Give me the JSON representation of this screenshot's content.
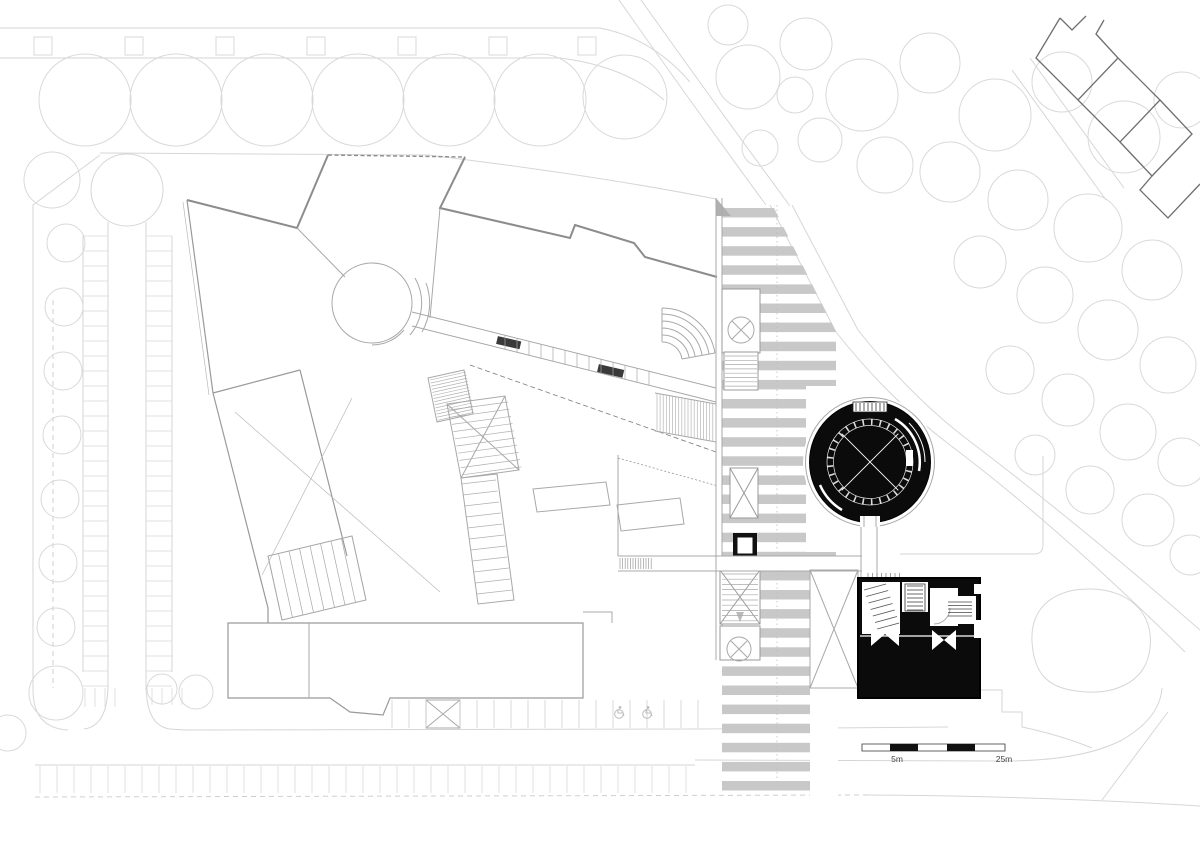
{
  "title": "Architectural site plan - ground floor",
  "scale_bar": {
    "label_left": "5m",
    "label_right": "25m"
  },
  "palette": {
    "background": "#ffffff",
    "line_faint": "#d6d6d6",
    "line_light": "#c8c8c8",
    "line_mid": "#a8a8a8",
    "line_dark": "#8c8c8c",
    "neighbor_outline": "#6e6e6e",
    "crosswalk_stripe": "#c8c8c8",
    "solid_black": "#0b0b0b",
    "label_text": "#444444",
    "wheelchair_icon": "#bdbdbd"
  },
  "icons": {
    "wheelchair": "wheelchair-icon",
    "column_cross": "circle-x-icon",
    "crossing_marker": "triangle-marker-icon"
  },
  "geometry": {
    "trees_top": [
      [
        85,
        100,
        46
      ],
      [
        176,
        100,
        46
      ],
      [
        267,
        100,
        46
      ],
      [
        358,
        100,
        46
      ],
      [
        449,
        100,
        46
      ],
      [
        540,
        100,
        46
      ],
      [
        625,
        97,
        42
      ]
    ],
    "trees_left": [
      [
        52,
        180,
        28
      ],
      [
        66,
        243,
        19
      ],
      [
        64,
        307,
        19
      ],
      [
        63,
        371,
        19
      ],
      [
        62,
        435,
        19
      ],
      [
        60,
        499,
        19
      ],
      [
        58,
        563,
        19
      ],
      [
        56,
        627,
        19
      ]
    ],
    "trees_right": [
      [
        728,
        25,
        20
      ],
      [
        748,
        77,
        32
      ],
      [
        806,
        44,
        26
      ],
      [
        862,
        95,
        36
      ],
      [
        930,
        63,
        30
      ],
      [
        995,
        115,
        36
      ],
      [
        1062,
        82,
        30
      ],
      [
        1124,
        137,
        36
      ],
      [
        1182,
        100,
        28
      ],
      [
        820,
        140,
        22
      ],
      [
        885,
        165,
        28
      ],
      [
        950,
        172,
        30
      ],
      [
        1018,
        200,
        30
      ],
      [
        1088,
        228,
        34
      ],
      [
        1152,
        270,
        30
      ],
      [
        980,
        262,
        26
      ],
      [
        1045,
        295,
        28
      ],
      [
        1108,
        330,
        30
      ],
      [
        1168,
        365,
        28
      ],
      [
        1010,
        370,
        24
      ],
      [
        1068,
        400,
        26
      ],
      [
        1128,
        432,
        28
      ],
      [
        1182,
        462,
        24
      ],
      [
        1035,
        455,
        20
      ],
      [
        1090,
        490,
        24
      ],
      [
        1148,
        520,
        26
      ],
      [
        1190,
        555,
        20
      ],
      [
        760,
        148,
        18
      ],
      [
        795,
        95,
        18
      ]
    ],
    "trees_bottom": [
      [
        56,
        693,
        27
      ],
      [
        8,
        733,
        18
      ],
      [
        162,
        689,
        15
      ],
      [
        196,
        692,
        17
      ]
    ],
    "squares_top": {
      "y": 37,
      "size": 18,
      "xs": [
        34,
        125,
        216,
        307,
        398,
        489,
        578
      ]
    },
    "crosswalk_stripes": {
      "x": 722,
      "width": 114,
      "y_start": 208,
      "period": 19.1,
      "height": 9.5,
      "count": 31
    },
    "hatches": [
      {
        "name": "left-stalls-west",
        "x1": 83,
        "y1": 236,
        "x2": 108,
        "y2": 236,
        "n": 31,
        "dx": 0,
        "dy": 15,
        "color": "#d9d9d9",
        "w": 0.8
      },
      {
        "name": "left-stalls-east",
        "x1": 146,
        "y1": 236,
        "x2": 172,
        "y2": 236,
        "n": 31,
        "dx": 0,
        "dy": 15,
        "color": "#d9d9d9",
        "w": 0.8
      },
      {
        "name": "bottom-stalls",
        "x1": 40,
        "y1": 766,
        "x2": 40,
        "y2": 793,
        "n": 39,
        "dx": 17,
        "dy": 0,
        "color": "#d9d9d9",
        "w": 0.8
      },
      {
        "name": "mid-stalls-a",
        "x1": 392,
        "y1": 700,
        "x2": 392,
        "y2": 728,
        "n": 3,
        "dx": 17,
        "dy": 0,
        "color": "#cfcfcf",
        "w": 0.8
      },
      {
        "name": "mid-stalls-b",
        "x1": 460,
        "y1": 700,
        "x2": 460,
        "y2": 728,
        "n": 15,
        "dx": 17,
        "dy": 0,
        "color": "#cfcfcf",
        "w": 0.8
      },
      {
        "name": "corner-stall-a",
        "x1": 85,
        "y1": 688,
        "x2": 85,
        "y2": 707,
        "n": 4,
        "dx": 10,
        "dy": 0,
        "color": "#d9d9d9",
        "w": 0.8
      },
      {
        "name": "corner-stall-b",
        "x1": 152,
        "y1": 688,
        "x2": 152,
        "y2": 705,
        "n": 4,
        "dx": 10,
        "dy": 0,
        "color": "#d9d9d9",
        "w": 0.8
      },
      {
        "name": "entry-ramp",
        "x1": 657,
        "y1": 394,
        "x2": 657,
        "y2": 431,
        "n": 20,
        "dx": 3.1,
        "dy": 0.55,
        "color": "#b5b5b5",
        "w": 0.7
      },
      {
        "name": "bridge-hatch",
        "x1": 620,
        "y1": 558,
        "x2": 620,
        "y2": 569,
        "n": 13,
        "dx": 2.6,
        "dy": 0,
        "color": "#9a9a9a",
        "w": 0.7
      },
      {
        "name": "main-stair-treads",
        "x1": 449,
        "y1": 410,
        "x2": 508,
        "y2": 402,
        "n": 10,
        "dx": 1.5,
        "dy": 7.2,
        "color": "#b0b0b0",
        "w": 0.7
      },
      {
        "name": "lower-stair-treads",
        "x1": 461,
        "y1": 484,
        "x2": 496,
        "y2": 480,
        "n": 11,
        "dx": 1.6,
        "dy": 11,
        "color": "#b0b0b0",
        "w": 0.7
      },
      {
        "name": "dense-stair-hatch",
        "x1": 430,
        "y1": 380,
        "x2": 466,
        "y2": 372,
        "n": 14,
        "dx": 0.6,
        "dy": 3.1,
        "color": "#a8a8a8",
        "w": 0.6
      },
      {
        "name": "cw-stair-upper",
        "x1": 725,
        "y1": 356,
        "x2": 757,
        "y2": 356,
        "n": 8,
        "dx": 0,
        "dy": 4.3,
        "color": "#a8a8a8",
        "w": 0.7
      },
      {
        "name": "cw-stair-lower",
        "x1": 722,
        "y1": 574,
        "x2": 758,
        "y2": 574,
        "n": 10,
        "dx": 0,
        "dy": 5.2,
        "color": "#a8a8a8",
        "w": 0.7
      },
      {
        "name": "blackbox-ladder",
        "x1": 907,
        "y1": 586,
        "x2": 923,
        "y2": 586,
        "n": 7,
        "dx": 0,
        "dy": 4,
        "color": "#444444",
        "w": 0.8
      },
      {
        "name": "blackbox-stair-hatch",
        "x1": 864,
        "y1": 590,
        "x2": 886,
        "y2": 584,
        "n": 7,
        "dx": 2.2,
        "dy": 6.5,
        "color": "#555555",
        "w": 0.8
      },
      {
        "name": "blackbox-fixture",
        "x1": 948,
        "y1": 602,
        "x2": 972,
        "y2": 602,
        "n": 5,
        "dx": 0,
        "dy": 3.5,
        "color": "#444444",
        "w": 0.8
      },
      {
        "name": "wing-room-partitions",
        "x1": 268,
        "y1": 556,
        "x2": 282,
        "y2": 620,
        "n": 9,
        "dx": 10.5,
        "dy": -2.5,
        "color": "#a8a8a8",
        "w": 0.7
      },
      {
        "name": "corridor-partitions",
        "x1": 505,
        "y1": 335,
        "x2": 505,
        "y2": 349,
        "n": 13,
        "dx": 12,
        "dy": 3,
        "color": "#a8a8a8",
        "w": 0.7
      },
      {
        "name": "rotunda-top-ticks",
        "x1": 856,
        "y1": 403,
        "x2": 856,
        "y2": 411,
        "n": 8,
        "dx": 4,
        "dy": 0,
        "color": "#333333",
        "w": 0.8
      },
      {
        "name": "blackbox-top-ticks",
        "x1": 868,
        "y1": 573,
        "x2": 868,
        "y2": 577,
        "n": 8,
        "dx": 4.5,
        "dy": 0,
        "color": "#888888",
        "w": 0.8
      }
    ],
    "wheelchair_positions": [
      [
        619,
        713
      ],
      [
        647,
        713
      ]
    ]
  }
}
